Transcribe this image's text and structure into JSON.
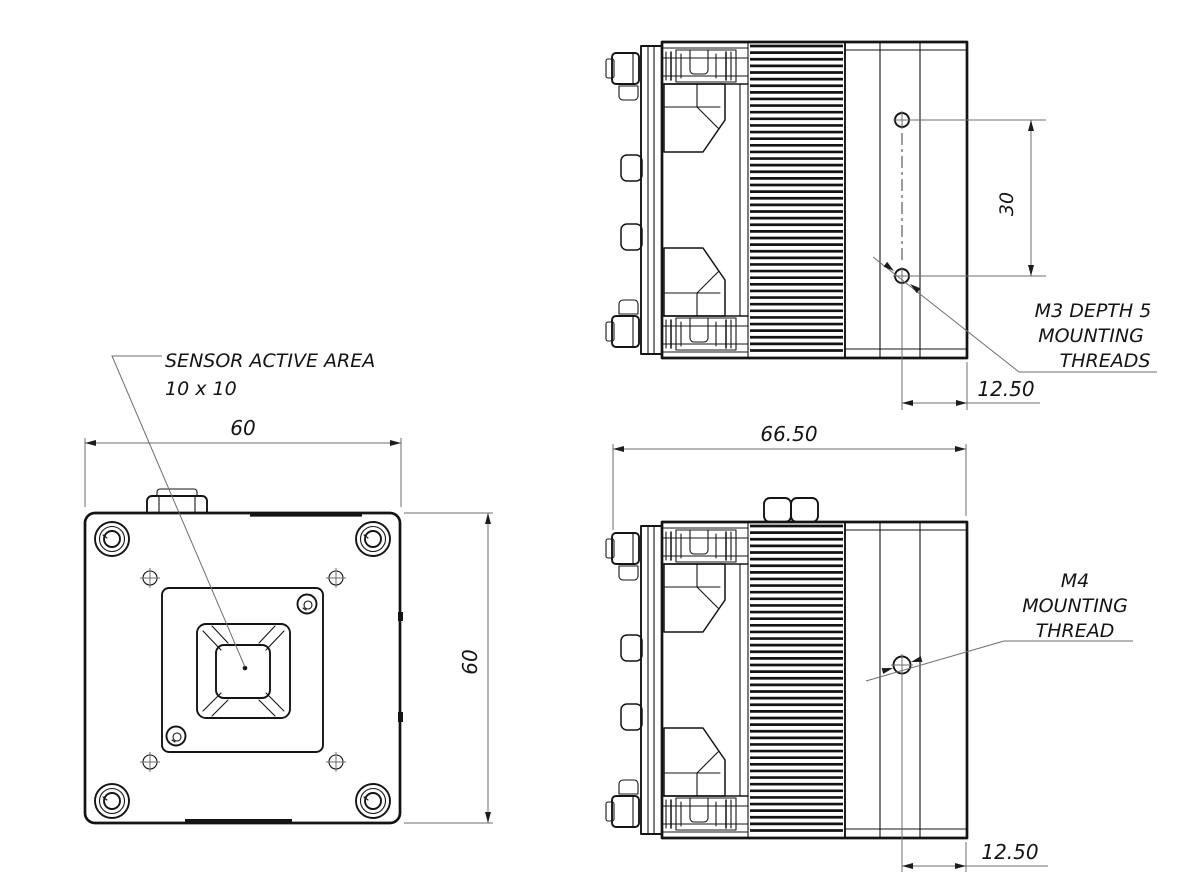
{
  "title": "camera-heatsink-engineering-drawing",
  "front_view": {
    "sensor_callout_line1": "SENSOR ACTIVE AREA",
    "sensor_callout_line2": "10 x 10",
    "width_dim": "60",
    "height_dim": "60"
  },
  "side_view_top": {
    "hole_spacing_dim": "30",
    "thread_callout_line1": "M3 DEPTH 5",
    "thread_callout_line2": "MOUNTING",
    "thread_callout_line3": "THREADS",
    "hole_offset_dim": "12.50"
  },
  "side_view_bottom": {
    "overall_width_dim": "66.50",
    "thread_callout_line1": "M4",
    "thread_callout_line2": "MOUNTING",
    "thread_callout_line3": "THREAD",
    "hole_offset_dim": "12.50"
  },
  "colors": {
    "outline": "#141414",
    "dimension_line": "#6e6e6e",
    "background": "#ffffff"
  }
}
